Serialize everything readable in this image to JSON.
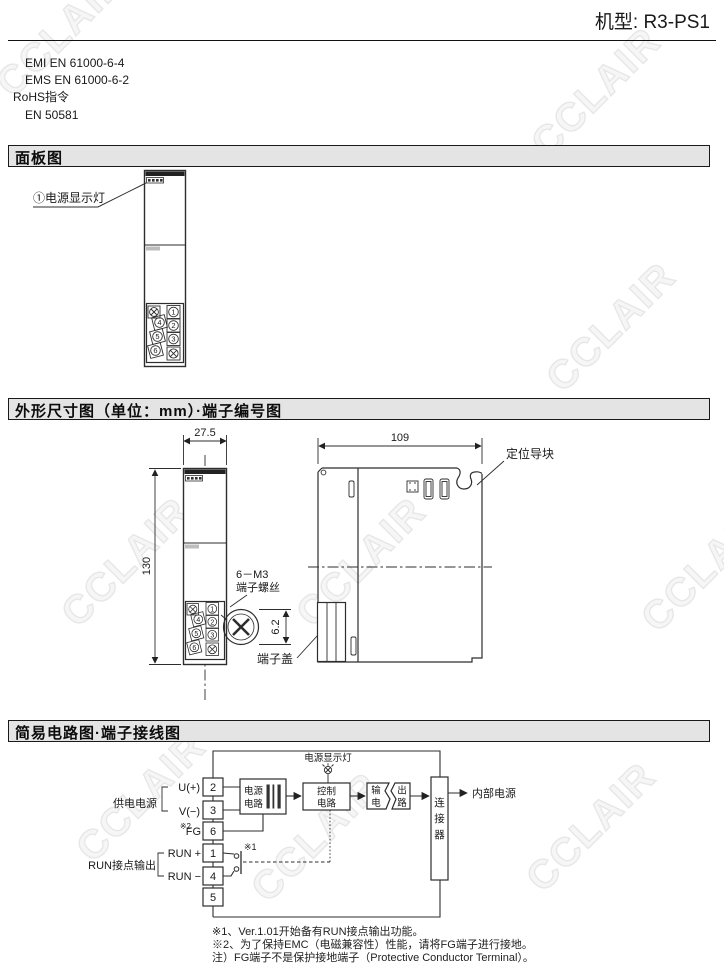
{
  "header": {
    "model": "机型: R3-PS1"
  },
  "watermark": {
    "text": "CCLAIR"
  },
  "standards": {
    "line1": "EMI EN 61000-6-4",
    "line2": "EMS EN 61000-6-2",
    "line3": "RoHS指令",
    "line4": "EN 50581"
  },
  "panel_section": {
    "title": "面板图",
    "led_label": "①电源显示灯"
  },
  "dim_section": {
    "title": "外形尺寸图（单位：mm）·端子编号图",
    "front_width": "27.5",
    "front_height": "130",
    "side_width": "109",
    "screw_label1": "6－M3",
    "screw_label2": "端子螺丝",
    "screw_dim": "6.2",
    "cover_label": "端子盖",
    "guide_label": "定位导块"
  },
  "terminals": {
    "t1": "1",
    "t2": "2",
    "t3": "3",
    "t4": "4",
    "t5": "5",
    "t6": "6"
  },
  "circuit_section": {
    "title": "简易电路图·端子接线图",
    "lamp_label": "电源显示灯",
    "supply_group": "供电电源",
    "u": "U(+)",
    "v": "V(−)",
    "fg_ref": "※2",
    "fg": "FG",
    "run_group": "RUN接点输出",
    "run_plus": "RUN +",
    "run_minus": "RUN −",
    "sw_ref": "※1",
    "blocks": {
      "power1": "电源",
      "power2": "电路",
      "ctrl1": "控制",
      "ctrl2": "电路",
      "out_tl": "输",
      "out_tr": "出",
      "out_bl": "电",
      "out_br": "路",
      "conn1": "连",
      "conn2": "接",
      "conn3": "器"
    },
    "internal_power": "内部电源",
    "note1": "※1、Ver.1.01开始备有RUN接点输出功能。",
    "note2": "※2、为了保持EMC（电磁兼容性）性能，请将FG端子进行接地。",
    "note3": "注）FG端子不是保护接地端子（Protective Conductor Terminal）。"
  }
}
